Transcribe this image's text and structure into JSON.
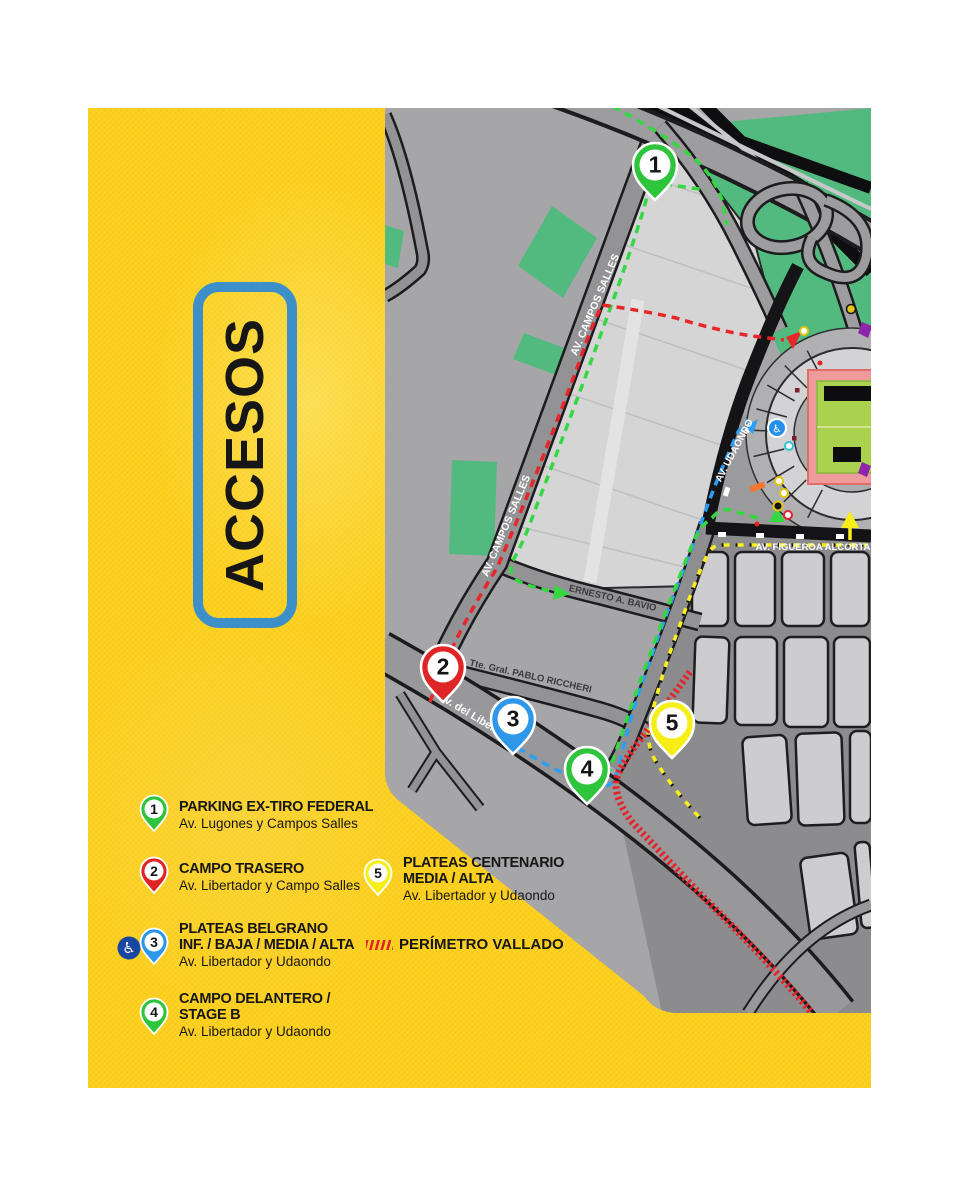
{
  "title_box": {
    "label": "ACCESOS"
  },
  "palette": {
    "yellow": "#fdd01a",
    "accesos_border": "#3d8fc9",
    "map_base": "#a6a6a8",
    "park_green": "#53ba7f",
    "route_green": "#35d743",
    "route_red": "#e8252a",
    "route_blue": "#2d9ff2",
    "route_yellow": "#f8ef1c",
    "perimeter_red": "#e22528"
  },
  "icons": {
    "wheelchair": "♿"
  },
  "legend": {
    "items": [
      {
        "number": "1",
        "pin_color": "#2ec43b",
        "lines": [
          "PARKING EX-TIRO FEDERAL"
        ],
        "location": "Av. Lugones y Campos Salles"
      },
      {
        "number": "2",
        "pin_color": "#e02527",
        "lines": [
          "CAMPO TRASERO"
        ],
        "location": "Av. Libertador y Campo Salles"
      },
      {
        "number": "3",
        "pin_color": "#2e97ea",
        "lines": [
          "PLATEAS BELGRANO",
          "INF. / BAJA / MEDIA / ALTA"
        ],
        "location": "Av. Libertador y Udaondo"
      },
      {
        "number": "4",
        "pin_color": "#2ec43b",
        "lines": [
          "CAMPO DELANTERO /",
          "STAGE B"
        ],
        "location": "Av. Libertador y Udaondo"
      },
      {
        "number": "5",
        "pin_color": "#f6ee17",
        "lines": [
          "PLATEAS CENTENARIO",
          "MEDIA / ALTA"
        ],
        "location": "Av. Libertador y Udaondo"
      }
    ],
    "perimeter": {
      "label": "PERÍMETRO VALLADO"
    }
  },
  "map": {
    "markers": [
      {
        "number": "1",
        "color": "#2ec43b"
      },
      {
        "number": "2",
        "color": "#e02527"
      },
      {
        "number": "3",
        "color": "#2e97ea"
      },
      {
        "number": "4",
        "color": "#2ec43b"
      },
      {
        "number": "5",
        "color": "#f6ee17"
      }
    ],
    "streets": {
      "campos_salles": "AV. CAMPOS SALLES",
      "bavio": "ERNESTO A. BAVIO",
      "riccheri": "Tte. Gral. PABLO RICCHERI",
      "libertador": "Av. del Libertador",
      "udaondo": "AV. UDAONDO",
      "figueroa": "AV. FIGUEROA ALCORTA"
    }
  }
}
